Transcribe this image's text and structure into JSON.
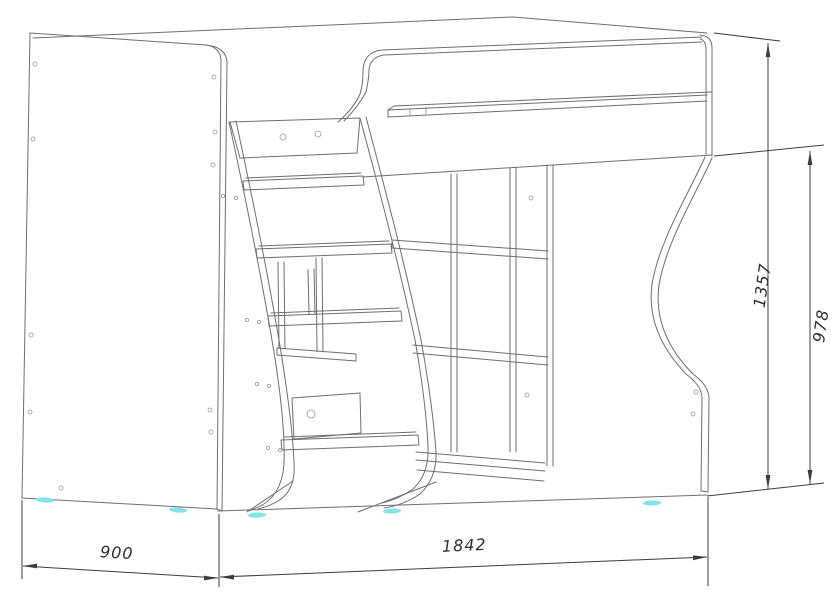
{
  "drawing": {
    "type": "furniture-assembly-technical-drawing",
    "subject": "loft-bed-with-ladder-and-shelving",
    "dimensions": {
      "depth_mm": "900",
      "width_mm": "1842",
      "height_total_mm": "1357",
      "height_under_bed_mm": "978"
    },
    "style": {
      "line_color": "#6f6f6f",
      "dimension_color": "#3d3d3d",
      "background": "#ffffff",
      "feet_accent_color": "#82e3e8"
    }
  }
}
